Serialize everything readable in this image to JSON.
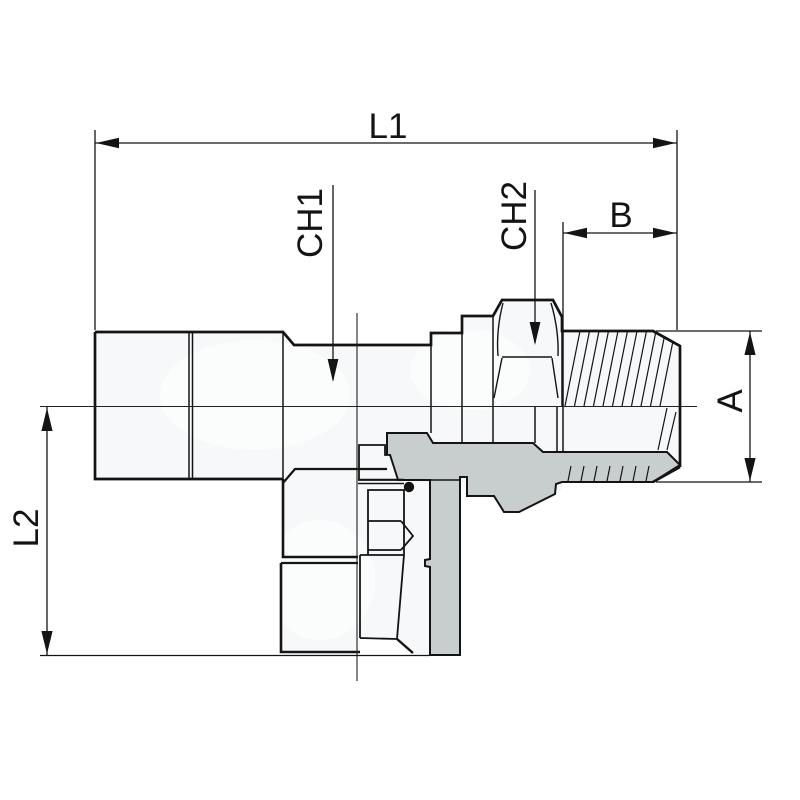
{
  "drawing": {
    "type": "technical-drawing-cross-section",
    "subject": "adjustable tee / banjo pipe fitting with male stud, hex flats and swivel nut",
    "labels": {
      "l1": "L1",
      "l2": "L2",
      "ch1": "CH1",
      "ch2": "CH2",
      "a": "A",
      "b": "B"
    },
    "colors": {
      "outline": "#141414",
      "section_fill": "#c7cecd",
      "body_fill": "#f7f8f9",
      "background": "#ffffff"
    }
  }
}
